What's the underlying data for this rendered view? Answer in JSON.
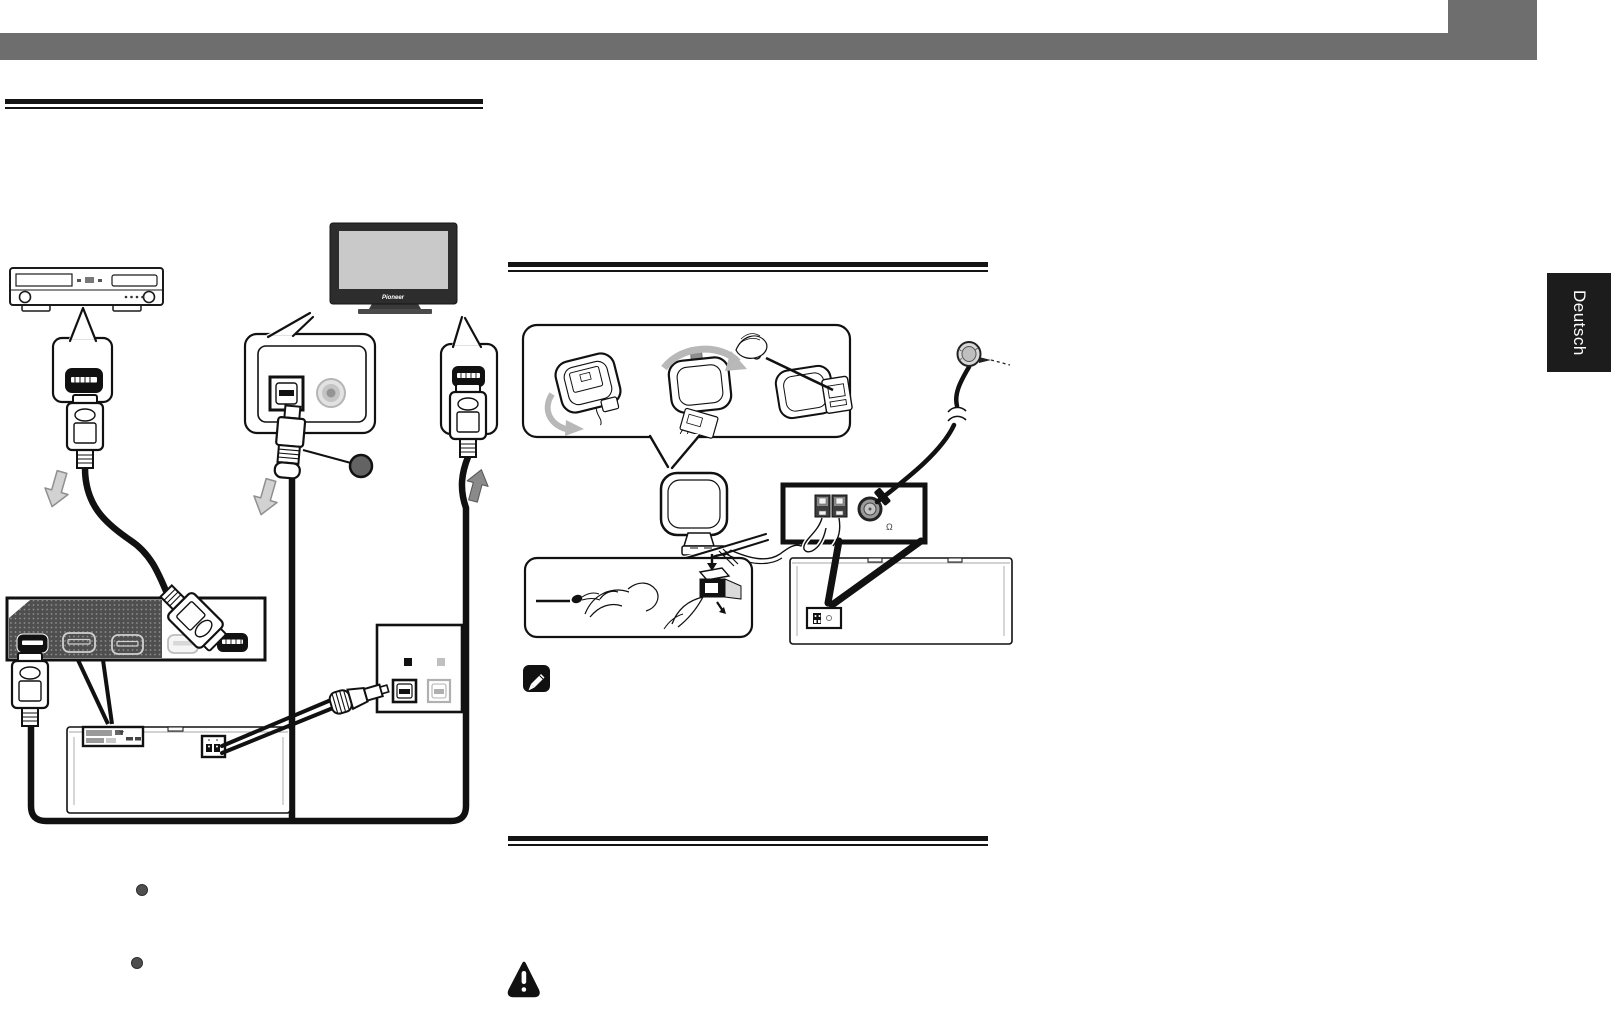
{
  "page": {
    "type": "instruction-manual-page",
    "language_tab": "Deutsch"
  },
  "hdmi_diagram": {
    "tv_brand": "Pioneer",
    "marker_color": "#636363"
  },
  "antenna_diagram": {
    "fm_jack_symbol": "Ω"
  },
  "icons": {
    "note": "pencil",
    "caution": "exclamation-triangle",
    "flow_arrows": "direction-arrows"
  },
  "colors": {
    "header_bar": "#6e6e6e",
    "language_tab_bg": "#1c1c1c",
    "language_tab_fg": "#ffffff",
    "line_art": "#1a1a1a",
    "panel_dark": "#4f4f4f",
    "tv_bezel": "#2d2d2d",
    "tv_screen": "#c9c9c9",
    "gray_arrow_outline": "#d2d2d2",
    "gray_arrow_solid": "#8a8a8a",
    "assembly_arrow": "#b8b8b8",
    "callout_marker": "#636363"
  }
}
